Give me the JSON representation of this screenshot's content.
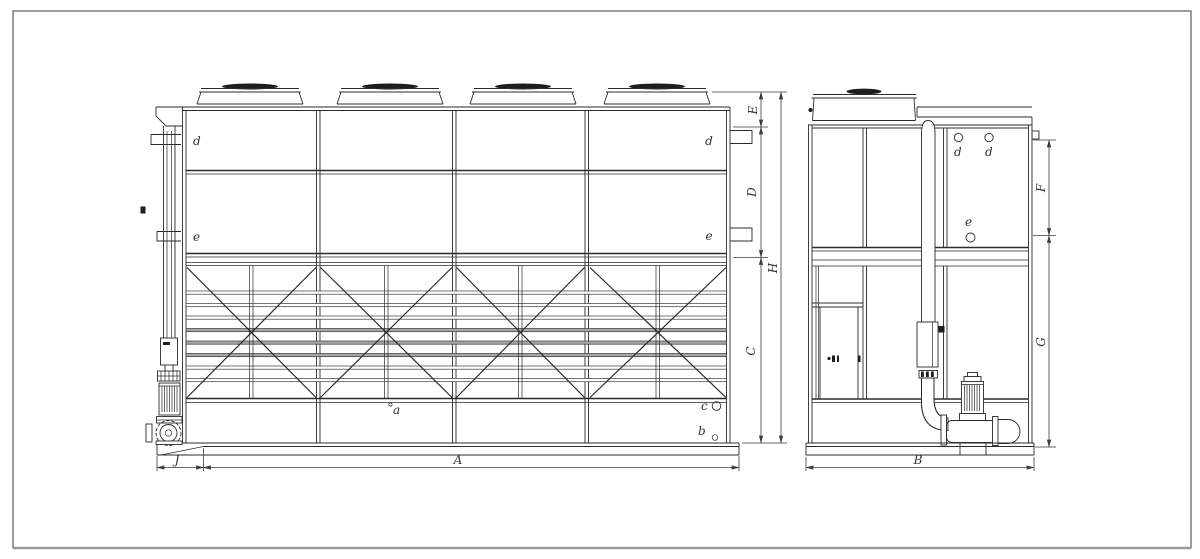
{
  "front_view": {
    "part_labels": {
      "d_left": "d",
      "e_left": "e",
      "d_right": "d",
      "e_right": "e",
      "a": "a",
      "b": "b",
      "c": "c"
    },
    "dimensions": {
      "E": "E",
      "D": "D",
      "H": "H",
      "C": "C",
      "A": "A",
      "J": "J"
    }
  },
  "side_view": {
    "part_labels": {
      "d1": "d",
      "d2": "d",
      "e": "e"
    },
    "dimensions": {
      "F": "F",
      "G": "G",
      "B": "B"
    }
  },
  "colors": {
    "line": "#2b2b2b",
    "slat_gray": "#a6a6a6",
    "dark_fill": "#1e1e1e",
    "border": "#555555",
    "background": "#ffffff"
  }
}
